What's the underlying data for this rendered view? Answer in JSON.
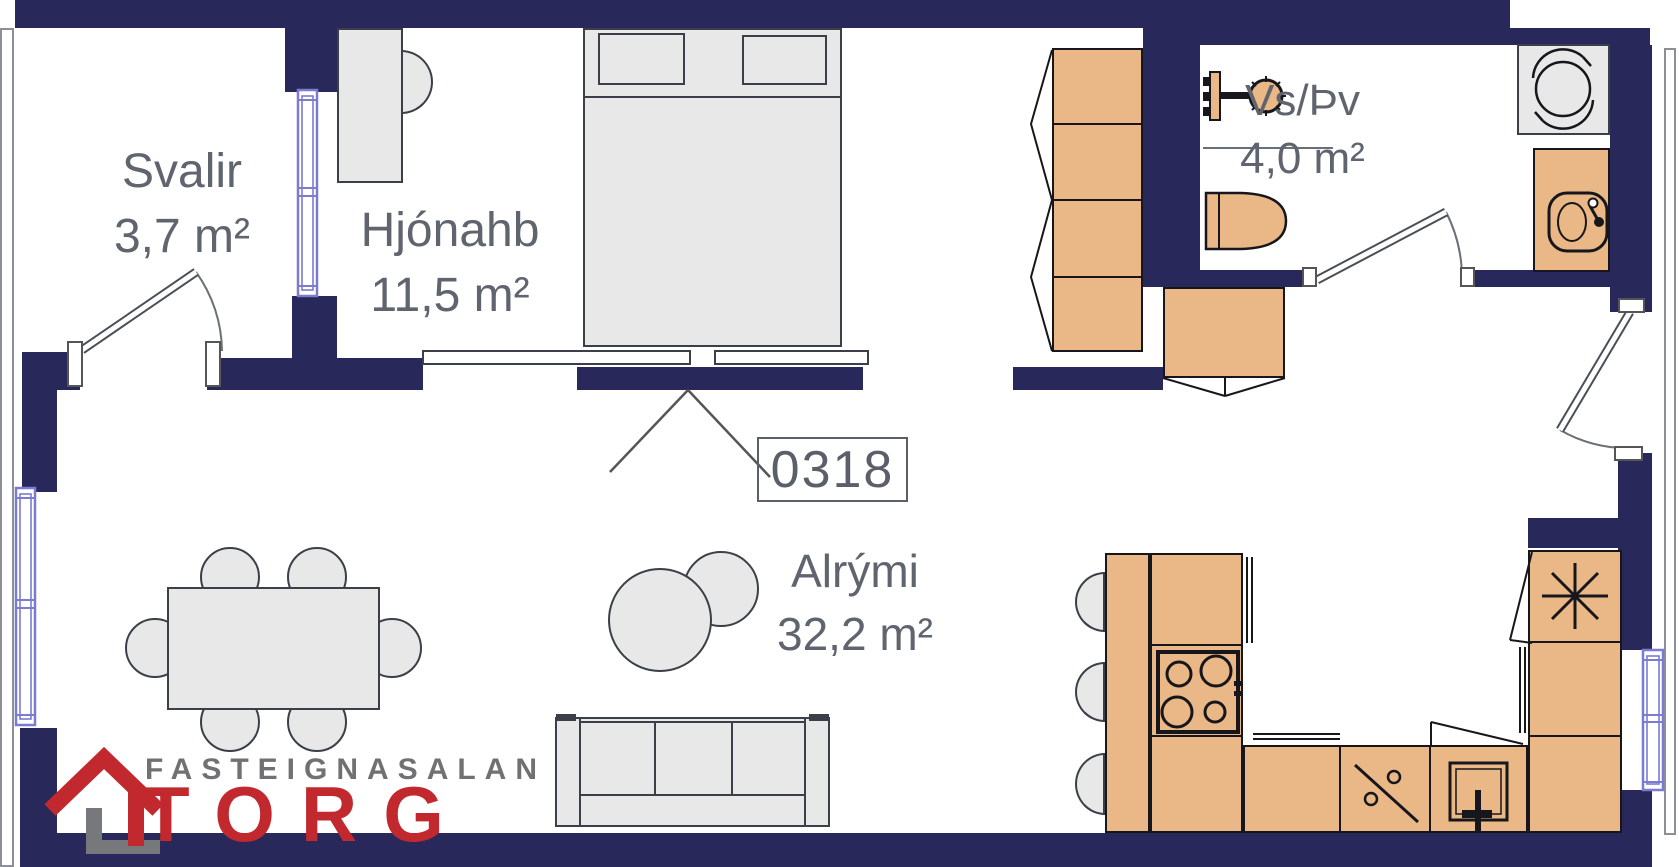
{
  "plan": {
    "unit_number": "0318",
    "rooms": [
      {
        "name": "Svalir",
        "area": "3,7 m²"
      },
      {
        "name": "Hjónahb",
        "area": "11,5 m²"
      },
      {
        "name": "Vs/Þv",
        "area": "4,0 m²"
      },
      {
        "name": "Alrými",
        "area": "32,2 m²"
      }
    ],
    "fixture_icons": [
      "bed",
      "wardrobe",
      "desk",
      "dining-table",
      "sofa",
      "pouf",
      "kitchen-counter",
      "stove",
      "dishwasher",
      "kitchen-sink",
      "fridge",
      "bar-stool",
      "toilet",
      "shower",
      "washing-machine",
      "bathroom-sink",
      "hall-cabinet",
      "door",
      "window"
    ]
  },
  "branding": {
    "tagline": "FASTEIGNASALAN",
    "name": "TORG"
  },
  "colors": {
    "wall": "#28285b",
    "cabinet": "#eab886",
    "furniture": "#e7e8e7",
    "window": "#7b7bd0",
    "text": "#5f646e",
    "logo_red": "#c2292f",
    "logo_gray": "#6f7173"
  }
}
